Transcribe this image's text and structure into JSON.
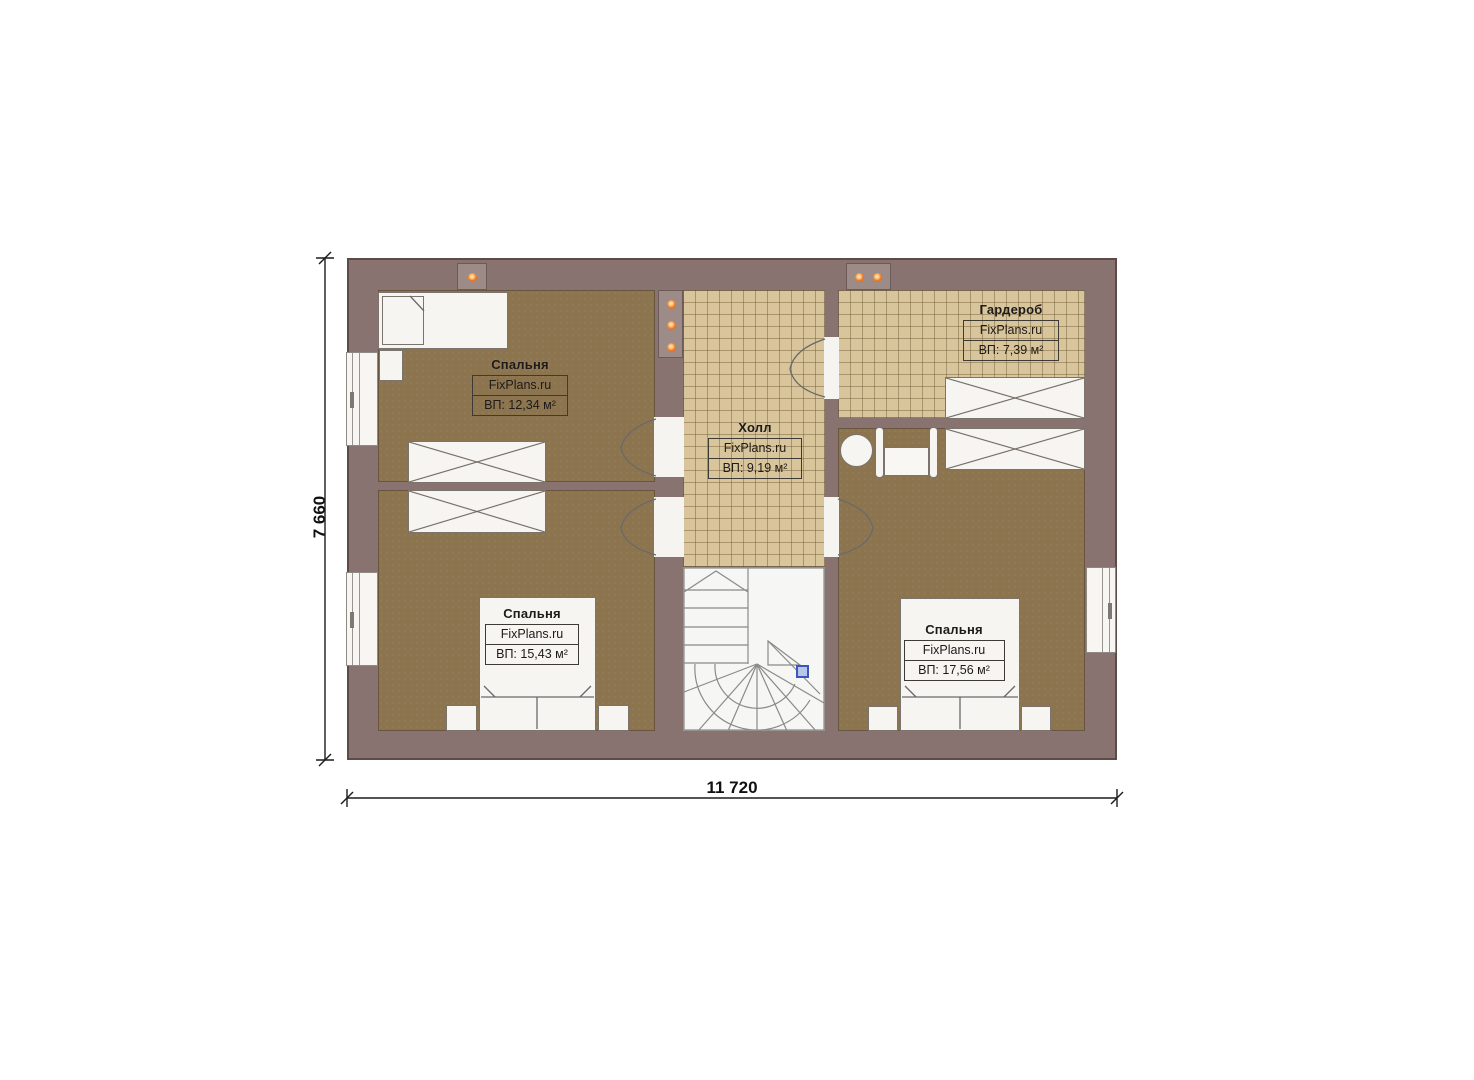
{
  "plan": {
    "watermark": "FixPlans.ru",
    "dimension_width": "11 720",
    "dimension_height": "7 660",
    "rooms": [
      {
        "name": "Спальня",
        "watermark": "FixPlans.ru",
        "area": "ВП: 12,34 м²"
      },
      {
        "name": "Холл",
        "watermark": "FixPlans.ru",
        "area": "ВП: 9,19 м²"
      },
      {
        "name": "Гардероб",
        "watermark": "FixPlans.ru",
        "area": "ВП: 7,39 м²"
      },
      {
        "name": "Спальня",
        "watermark": "FixPlans.ru",
        "area": "ВП: 15,43 м²"
      },
      {
        "name": "Спальня",
        "watermark": "FixPlans.ru",
        "area": "ВП: 17,56 м²"
      }
    ]
  },
  "colors": {
    "wall": "#897370",
    "floor_wood": "#8c744f",
    "floor_tile": "#d8c59b",
    "vent_orange": "#ef7a26",
    "stair_marker_blue": "#3a56c0"
  }
}
